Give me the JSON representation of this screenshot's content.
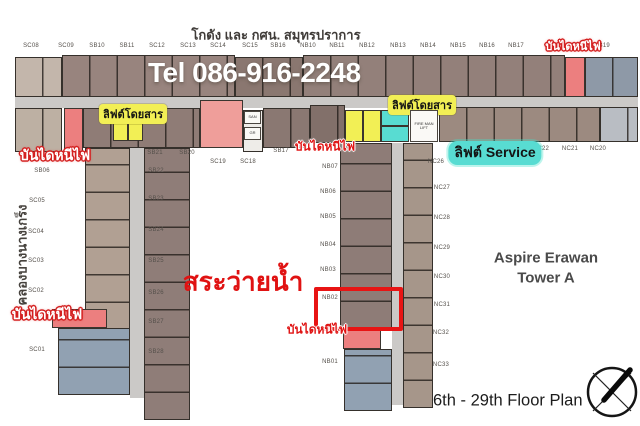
{
  "header": {
    "area_title": "โกดัง และ กศน. สมุทรปราการ",
    "phone": "Tel 086-916-2248"
  },
  "annotations": {
    "pool": "สระว่ายน้ำ",
    "tower_line1": "Aspire Erawan",
    "tower_line2": "Tower A",
    "floor_range": "6th - 29th Floor Plan",
    "canal": "คลองบางนางเกร็ง",
    "compass_icon": "north-arrow-compass"
  },
  "legend_labels": {
    "passenger_lift": "ลิฟต์โดยสาร",
    "service_lift": "ลิฟต์ Service",
    "fire_exit": "บันไดหนีไฟ"
  },
  "highlight": {
    "unit_label": "NB02"
  },
  "colors": {
    "accent_red": "#e01414",
    "highlight_box": "#e81414",
    "fire_escape_fill": "#ec7f7f",
    "passenger_lift_fill": "#f2ef55",
    "service_lift_fill": "#58dcd2",
    "corridor": "#cbc9c7",
    "unit_brown": "#94817b",
    "unit_beige": "#c0b2a5",
    "unit_grayblue": "#8e99a7"
  },
  "plan": {
    "unit_labels": [
      {
        "t": "SC08",
        "x": 31,
        "y": 46
      },
      {
        "t": "SC09",
        "x": 66,
        "y": 46
      },
      {
        "t": "SB10",
        "x": 97,
        "y": 46
      },
      {
        "t": "SB11",
        "x": 127,
        "y": 46
      },
      {
        "t": "SC12",
        "x": 157,
        "y": 46
      },
      {
        "t": "SC13",
        "x": 188,
        "y": 46
      },
      {
        "t": "SC14",
        "x": 218,
        "y": 46
      },
      {
        "t": "SC15",
        "x": 250,
        "y": 46
      },
      {
        "t": "SB16",
        "x": 278,
        "y": 46
      },
      {
        "t": "NB10",
        "x": 308,
        "y": 46
      },
      {
        "t": "NB11",
        "x": 337,
        "y": 46
      },
      {
        "t": "NB12",
        "x": 367,
        "y": 46
      },
      {
        "t": "NB13",
        "x": 398,
        "y": 46
      },
      {
        "t": "NB14",
        "x": 428,
        "y": 46
      },
      {
        "t": "NB15",
        "x": 458,
        "y": 46
      },
      {
        "t": "NB16",
        "x": 487,
        "y": 46
      },
      {
        "t": "NB17",
        "x": 516,
        "y": 46
      },
      {
        "t": "NB19",
        "x": 602,
        "y": 46
      },
      {
        "t": "SB06",
        "x": 42,
        "y": 171
      },
      {
        "t": "SB21",
        "x": 155,
        "y": 153
      },
      {
        "t": "SB20",
        "x": 187,
        "y": 153
      },
      {
        "t": "SC19",
        "x": 218,
        "y": 162
      },
      {
        "t": "SC18",
        "x": 248,
        "y": 162
      },
      {
        "t": "SB17",
        "x": 281,
        "y": 151
      },
      {
        "t": "NC23",
        "x": 513,
        "y": 149
      },
      {
        "t": "NC22",
        "x": 541,
        "y": 149
      },
      {
        "t": "NC21",
        "x": 570,
        "y": 149
      },
      {
        "t": "NC20",
        "x": 598,
        "y": 149
      },
      {
        "t": "SC05",
        "x": 37,
        "y": 201
      },
      {
        "t": "SC04",
        "x": 36,
        "y": 232
      },
      {
        "t": "SC03",
        "x": 36,
        "y": 261
      },
      {
        "t": "SC02",
        "x": 36,
        "y": 291
      },
      {
        "t": "SC01",
        "x": 37,
        "y": 350
      },
      {
        "t": "SB22",
        "x": 156,
        "y": 171
      },
      {
        "t": "SB23",
        "x": 156,
        "y": 199
      },
      {
        "t": "SB24",
        "x": 156,
        "y": 230
      },
      {
        "t": "SB25",
        "x": 156,
        "y": 261
      },
      {
        "t": "SB26",
        "x": 156,
        "y": 293
      },
      {
        "t": "SB27",
        "x": 156,
        "y": 322
      },
      {
        "t": "SB28",
        "x": 156,
        "y": 352
      },
      {
        "t": "NB07",
        "x": 330,
        "y": 167
      },
      {
        "t": "NB06",
        "x": 328,
        "y": 192
      },
      {
        "t": "NB05",
        "x": 328,
        "y": 217
      },
      {
        "t": "NB04",
        "x": 328,
        "y": 245
      },
      {
        "t": "NB03",
        "x": 328,
        "y": 270
      },
      {
        "t": "NB02",
        "x": 330,
        "y": 298
      },
      {
        "t": "NB01",
        "x": 330,
        "y": 362
      },
      {
        "t": "NC26",
        "x": 436,
        "y": 162
      },
      {
        "t": "NC27",
        "x": 442,
        "y": 188
      },
      {
        "t": "NC28",
        "x": 442,
        "y": 218
      },
      {
        "t": "NC29",
        "x": 442,
        "y": 248
      },
      {
        "t": "NC30",
        "x": 442,
        "y": 277
      },
      {
        "t": "NC31",
        "x": 442,
        "y": 305
      },
      {
        "t": "NC32",
        "x": 441,
        "y": 333
      },
      {
        "t": "NC33",
        "x": 441,
        "y": 365
      }
    ],
    "fire_exit_labels": [
      {
        "x": 573,
        "y": 46,
        "style": "wr",
        "s": 11
      },
      {
        "x": 55,
        "y": 156,
        "style": "wr",
        "s": 14
      },
      {
        "x": 325,
        "y": 147,
        "style": "rw",
        "s": 12
      },
      {
        "x": 47,
        "y": 315,
        "style": "wr",
        "s": 14
      },
      {
        "x": 317,
        "y": 330,
        "style": "rw",
        "s": 12
      }
    ],
    "lift_labels": [
      {
        "type": "passenger",
        "x": 133,
        "y": 114
      },
      {
        "type": "passenger",
        "x": 422,
        "y": 105
      },
      {
        "type": "service",
        "x": 495,
        "y": 153
      }
    ],
    "small_rooms": [
      {
        "t": "SAN",
        "x": 244,
        "y": 111,
        "w": 17,
        "h": 13
      },
      {
        "t": "GR",
        "x": 244,
        "y": 127,
        "w": 17,
        "h": 13
      },
      {
        "t": "FIRE MAN LIFT",
        "x": 410,
        "y": 110,
        "w": 28,
        "h": 32
      }
    ]
  }
}
